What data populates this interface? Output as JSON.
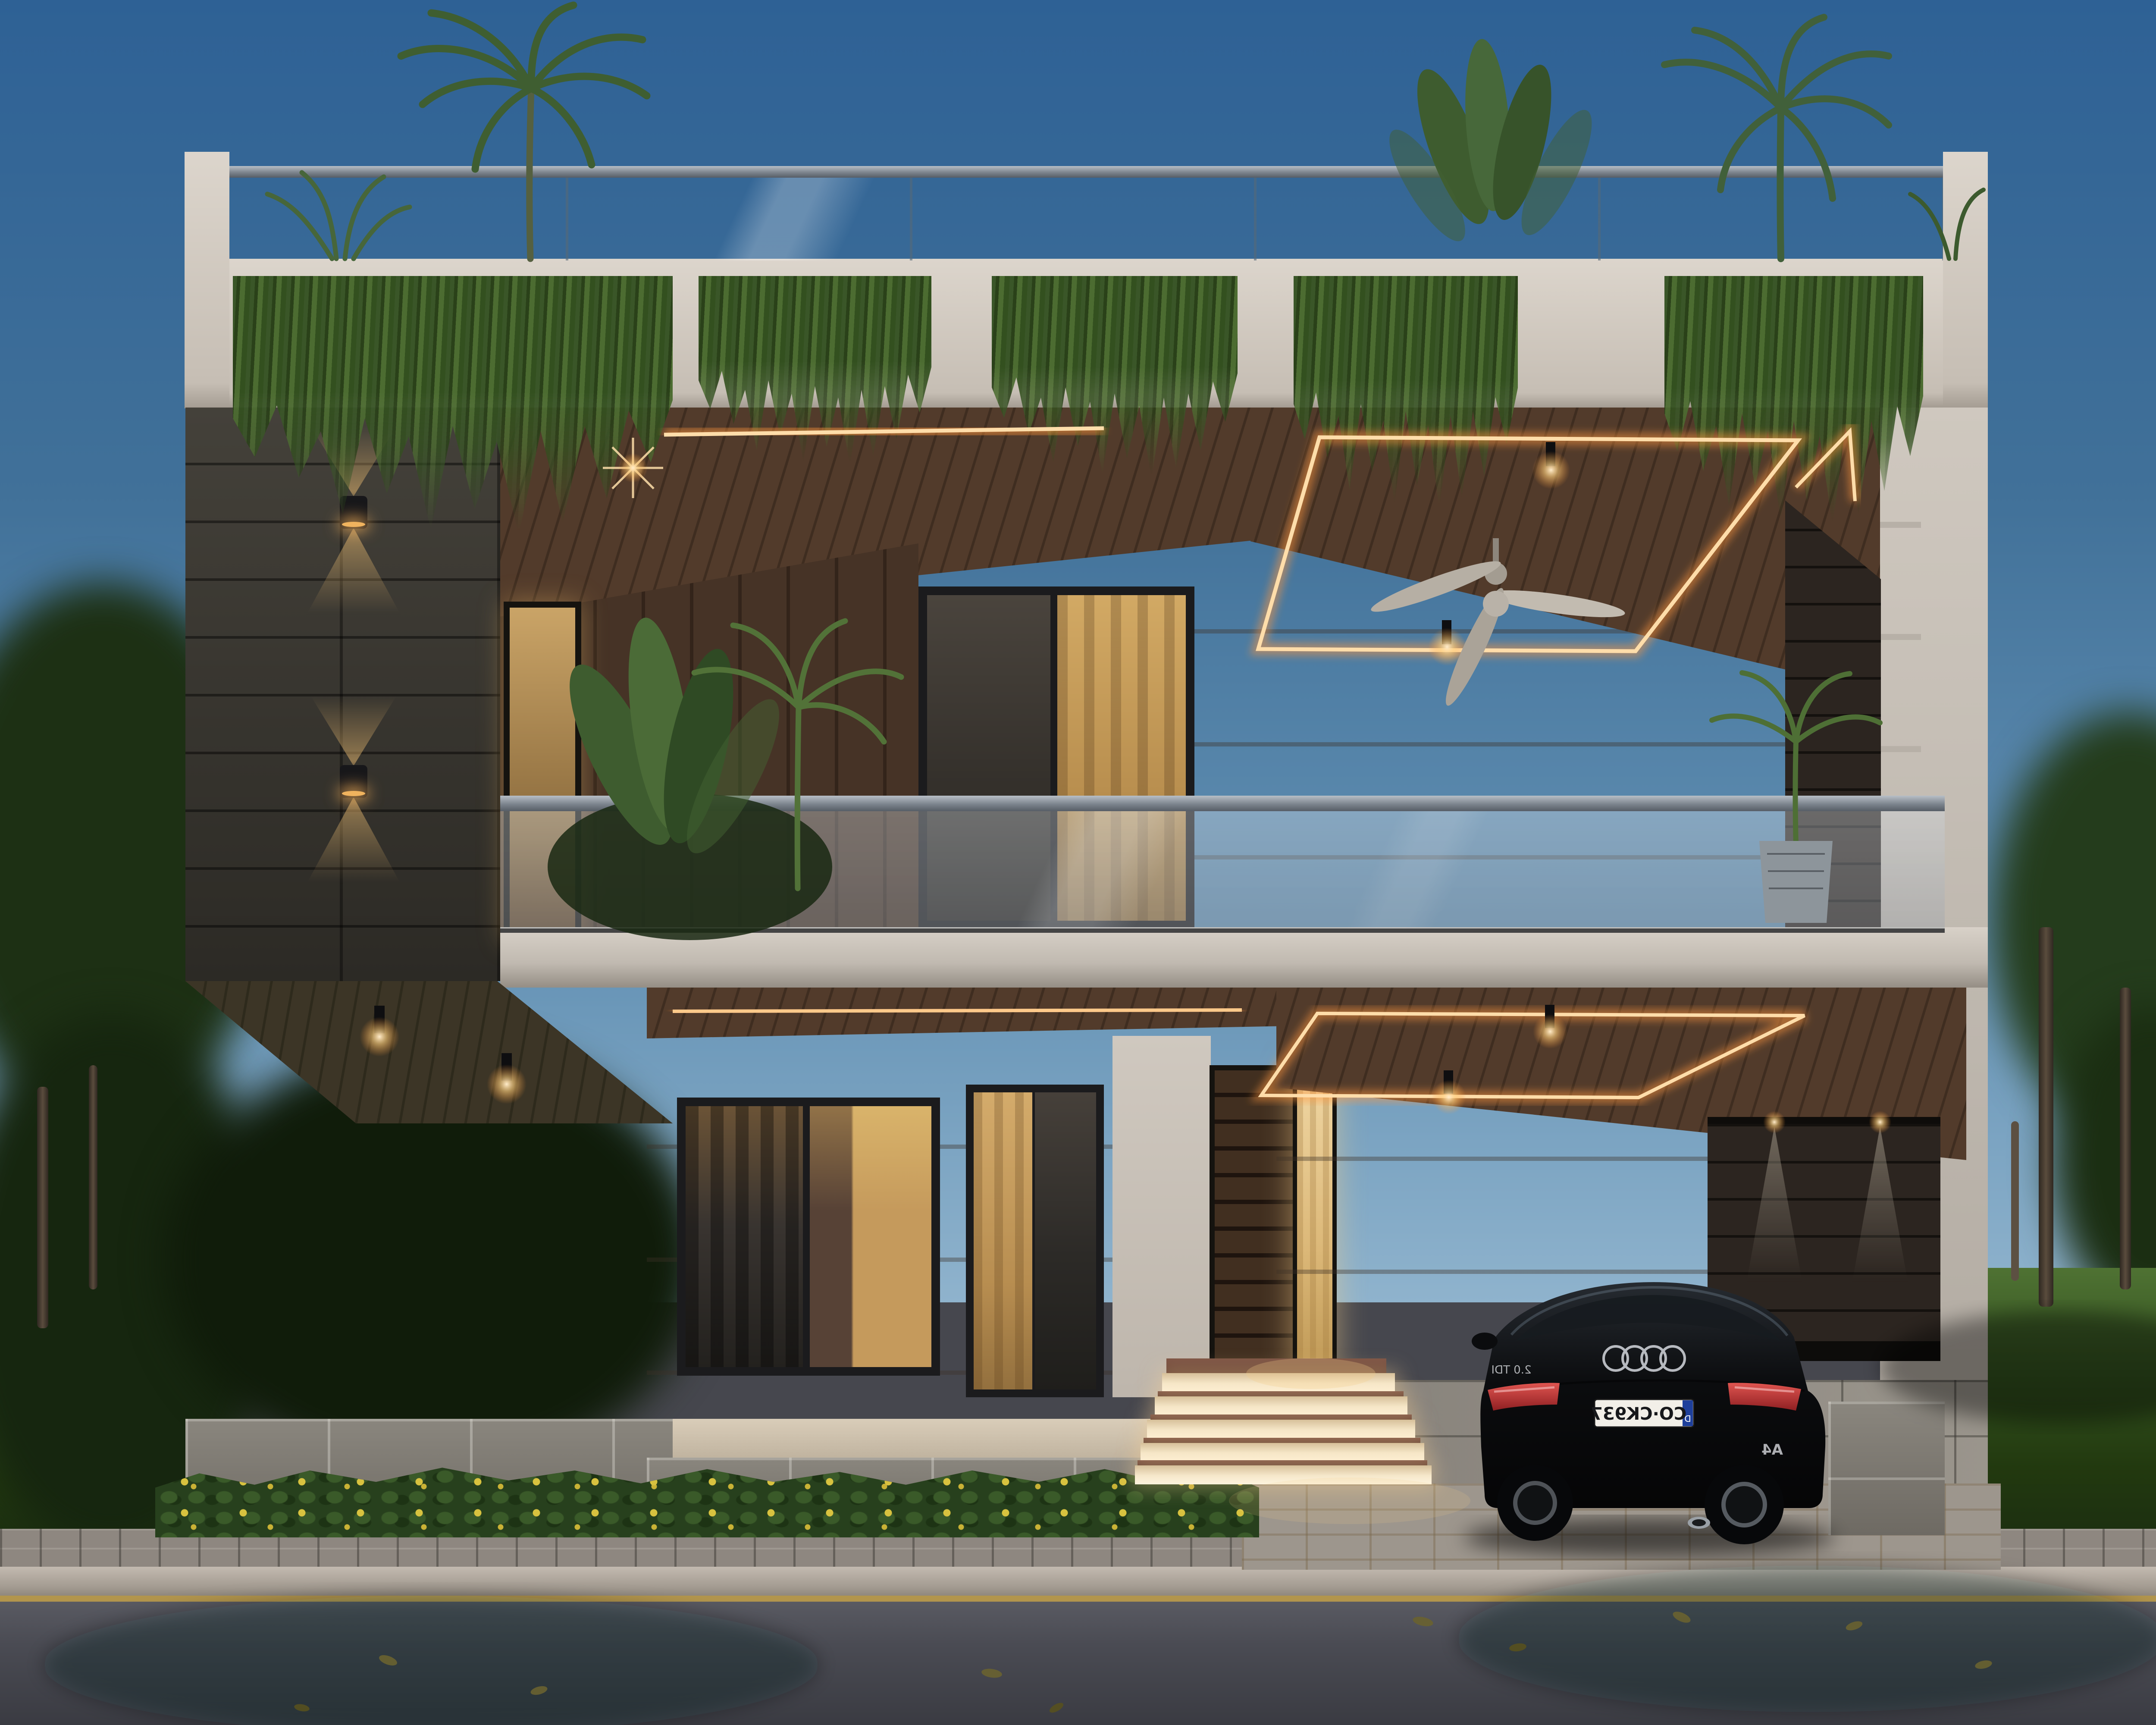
{
  "scene": {
    "description": "Dusk exterior render of a modern two-storey house: roof terrace with glass balustrade and tropical plants, trailing vines over the parapet, warm LED-outlined wood ceilings, dark stone feature column with up/down sconces, glazed balcony, covered porch with lit marble steps, carport with a black sedan, lawns, trees and an asphalt street in the foreground"
  },
  "colors": {
    "sky_top": "#2e6195",
    "sky_horizon": "#8fb3cd",
    "grass_light": "#4f7233",
    "grass_dark": "#1b2d11",
    "foliage": "#2c4420",
    "foliage_light": "#57793b",
    "road": "#45464d",
    "curb": "#b6ada4",
    "road_line_yellow": "#b2954d",
    "stucco_white": "#dcd5cc",
    "stucco_beige": "#b0a294",
    "stone_dark": "#39362f",
    "granite_base": "#7e7a72",
    "wood_dark": "#432f21",
    "door_walnut": "#3a291c",
    "frame_black": "#1b1b1d",
    "glass_sky_tint": "#aecbe0",
    "handrail_gray": "#7c848d",
    "led_warm": "#ffd9a2",
    "led_glow": "#ff9b40",
    "window_glow_amber": "#c89c5e",
    "curtain_cream": "#d8b87c",
    "step_marble": "#f2e3c4",
    "step_tread": "#6f473b",
    "car_black": "#0c0d10",
    "taillight_red": "#c13434",
    "plate_white": "#f2efe8",
    "plate_blue": "#1e3f9b",
    "flower_yellow": "#d8c23f"
  },
  "car": {
    "type": "black sedan parked in carport, rear view",
    "license_plate_text": "CO·CK937",
    "plate_band_text": "D",
    "badge_model": "A4",
    "badge_engine": "2.0 TDI",
    "brand_icon": "audi-rings-icon",
    "note": "plate and badges appear mirrored in the render"
  },
  "lighting": {
    "wall_sconces_on_stone_column": 2,
    "soffit_cylinder_downlights": 2,
    "terrace_ceiling_downlights": 2,
    "carport_ceiling_downlights": 2,
    "led_outline_strips": 2,
    "led_linear_strips": 2,
    "lit_step_risers": 5
  },
  "landscape": {
    "roof_plants": "palms, banana plants and trailing vines along the parapet",
    "balcony_plants": "tropical plants behind the glass balustrade",
    "foreground": "yellow flower bed, paved walk, curb and asphalt road with fallen leaves",
    "background": "lawns with trees on both sides"
  }
}
